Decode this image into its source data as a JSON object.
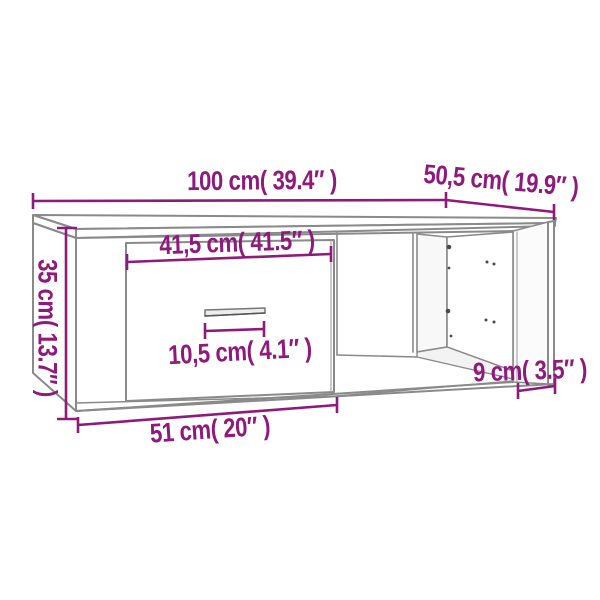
{
  "colors": {
    "accent": "#8e1a7c",
    "line": "#8a8a8a"
  },
  "diagram": {
    "labels": {
      "width_top": "100 cm( 39.4″ )",
      "depth_top": "50,5 cm( 19.9″ )",
      "height_left": "35 cm( 13.7″ )",
      "drawer_front_width": "41,5 cm( 41.5″ )",
      "handle_width": "10,5 cm( 4.1″ )",
      "bottom_left_width": "51 cm( 20″ )",
      "right_depth": "9 cm( 3.5″ )"
    }
  }
}
